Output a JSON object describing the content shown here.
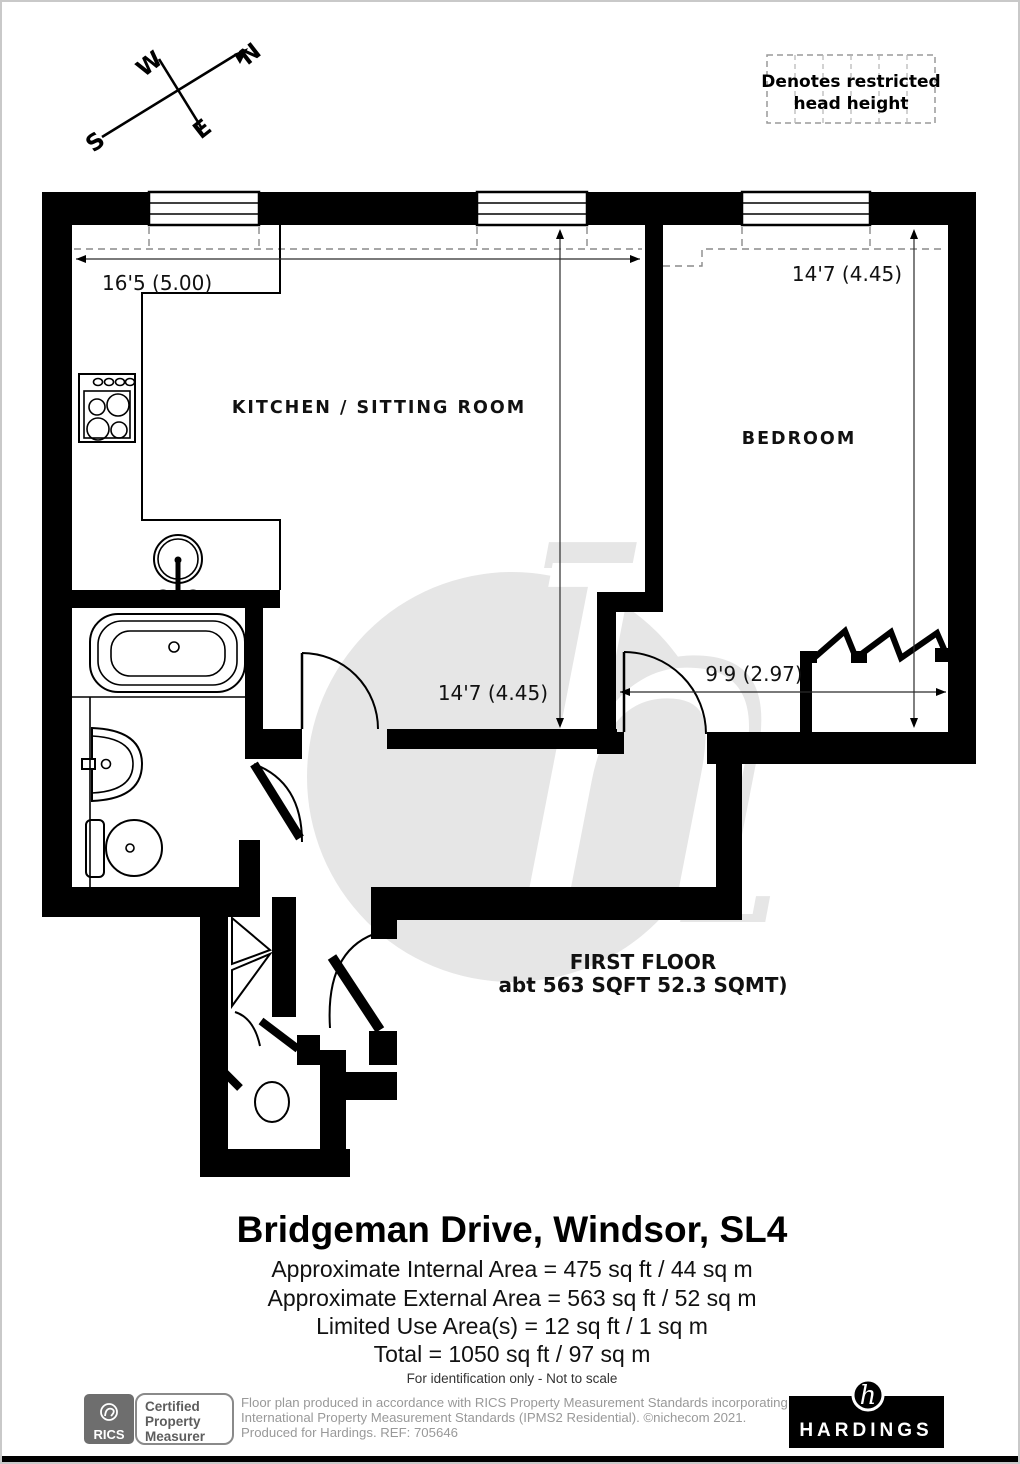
{
  "compass": {
    "north": "N",
    "east": "E",
    "south": "S",
    "west": "W"
  },
  "legend": {
    "line1": "Denotes restricted",
    "line2": "head height"
  },
  "plan": {
    "rooms": {
      "kitchen": "KITCHEN / SITTING ROOM",
      "bedroom": "BEDROOM"
    },
    "dimensions": {
      "kitchen_width": "16'5 (5.00)",
      "kitchen_depth": "14'7 (4.45)",
      "bedroom_depth": "14'7 (4.45)",
      "bedroom_lower_width": "9'9 (2.97)"
    },
    "floor_label": {
      "line1": "FIRST FLOOR",
      "line2": "abt 563 SQFT 52.3 SQMT)"
    },
    "watermark_letter": "h"
  },
  "summary": {
    "title": "Bridgeman Drive, Windsor, SL4",
    "lines": [
      "Approximate Internal Area = 475 sq ft / 44 sq m",
      "Approximate External Area = 563 sq ft / 52 sq m",
      "Limited Use Area(s) = 12 sq ft / 1 sq m",
      "Total = 1050 sq ft / 97 sq m"
    ],
    "note": "For identification only - Not to scale"
  },
  "footer": {
    "rics_label": "RICS",
    "certification": [
      "Certified",
      "Property",
      "Measurer"
    ],
    "disclaimer": [
      "Floor plan produced in accordance with RICS Property Measurement Standards incorporating",
      "International Property Measurement Standards (IPMS2 Residential).   ©nichecom 2021.",
      "Produced for Hardings.    REF:  705646"
    ],
    "agency": "HARDINGS",
    "agency_mark": "h"
  },
  "colors": {
    "wall": "#000000",
    "dashed_line": "#8a8a8a",
    "watermark": "#e6e6e6",
    "rics_box": "#6e6e6e",
    "footer_text": "#999999"
  }
}
